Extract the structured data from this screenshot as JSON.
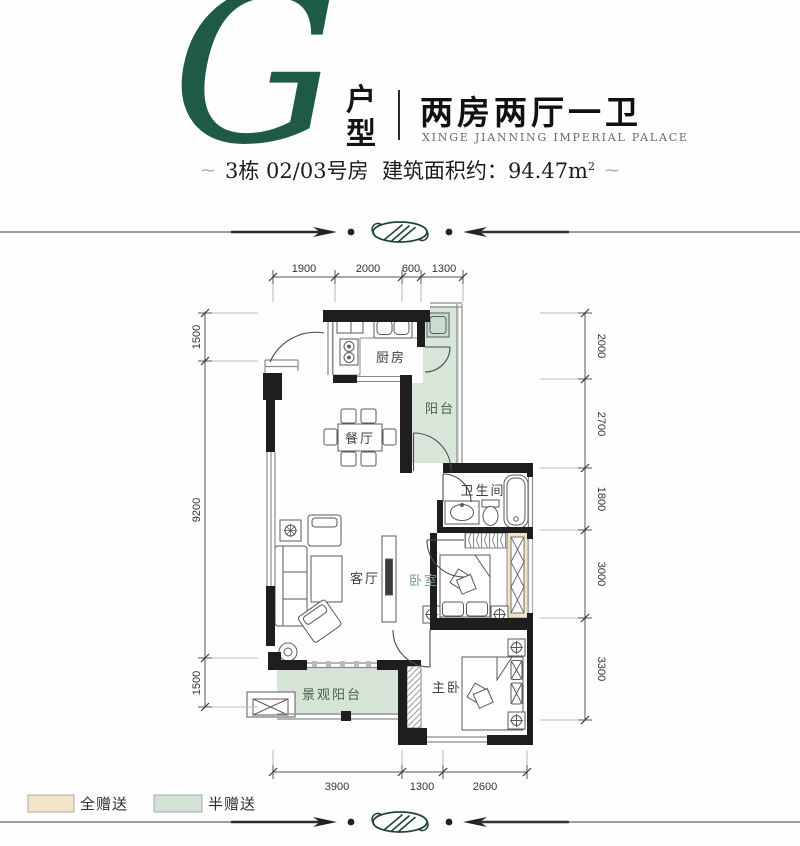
{
  "header": {
    "letter": "G",
    "type_label": "户\n型",
    "title": "两房两厅一卫",
    "subtitle_en": "XINGE JIANNING IMPERIAL PALACE",
    "info_building": "3栋 02/03号房",
    "info_area_label": "建筑面积约：",
    "info_area_value": "94.47m",
    "info_area_sup": "2",
    "deco": "⁓"
  },
  "plan": {
    "rooms": {
      "kitchen": "厨房",
      "balcony": "阳台",
      "dining": "餐厅",
      "living": "客厅",
      "bathroom": "卫生间",
      "bedroom": "卧室",
      "master": "主卧",
      "view_balcony": "景观阳台"
    },
    "dims": {
      "top": [
        "1900",
        "2000",
        "600",
        "1300"
      ],
      "left": [
        "1500",
        "9200",
        "1500"
      ],
      "right": [
        "2000",
        "2700",
        "1800",
        "3000",
        "3300"
      ],
      "bottom": [
        "3900",
        "1300",
        "2600"
      ]
    }
  },
  "legend": {
    "items": [
      {
        "label": "全赠送",
        "color": "#f2e6c6"
      },
      {
        "label": "半赠送",
        "color": "#d2e2d5"
      }
    ]
  },
  "colors": {
    "accent_green": "#1f5a48",
    "balcony_fill": "#d8e6da",
    "view_balcony_fill": "#d5e4d7",
    "bay_fill": "#f0e4c4",
    "wall": "#1e1e1e"
  }
}
